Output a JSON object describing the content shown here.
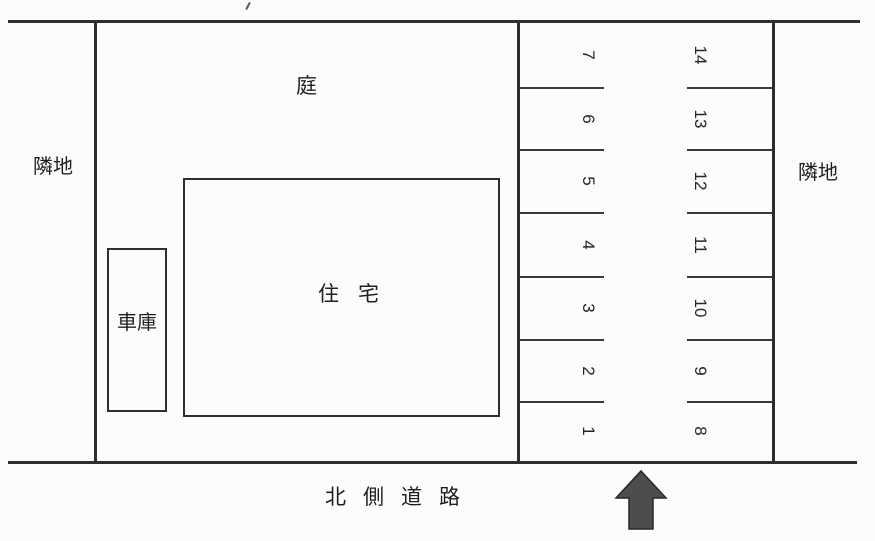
{
  "labels": {
    "garden": "庭",
    "house": "住宅",
    "garage": "車庫",
    "neighbor_left": "隣地",
    "neighbor_right": "隣地",
    "road": "北側道路"
  },
  "parking": {
    "left_column_top_to_bottom": [
      "7",
      "6",
      "5",
      "4",
      "3",
      "2",
      "1"
    ],
    "right_column_top_to_bottom": [
      "14",
      "13",
      "12",
      "11",
      "10",
      "9",
      "8"
    ]
  },
  "icons": {
    "entrance_arrow": "up-arrow-icon"
  },
  "colors": {
    "line": "#2e2e2e",
    "text": "#1f1f1f",
    "arrow_fill": "#4d4d4d",
    "background": "#fcfcfc"
  }
}
